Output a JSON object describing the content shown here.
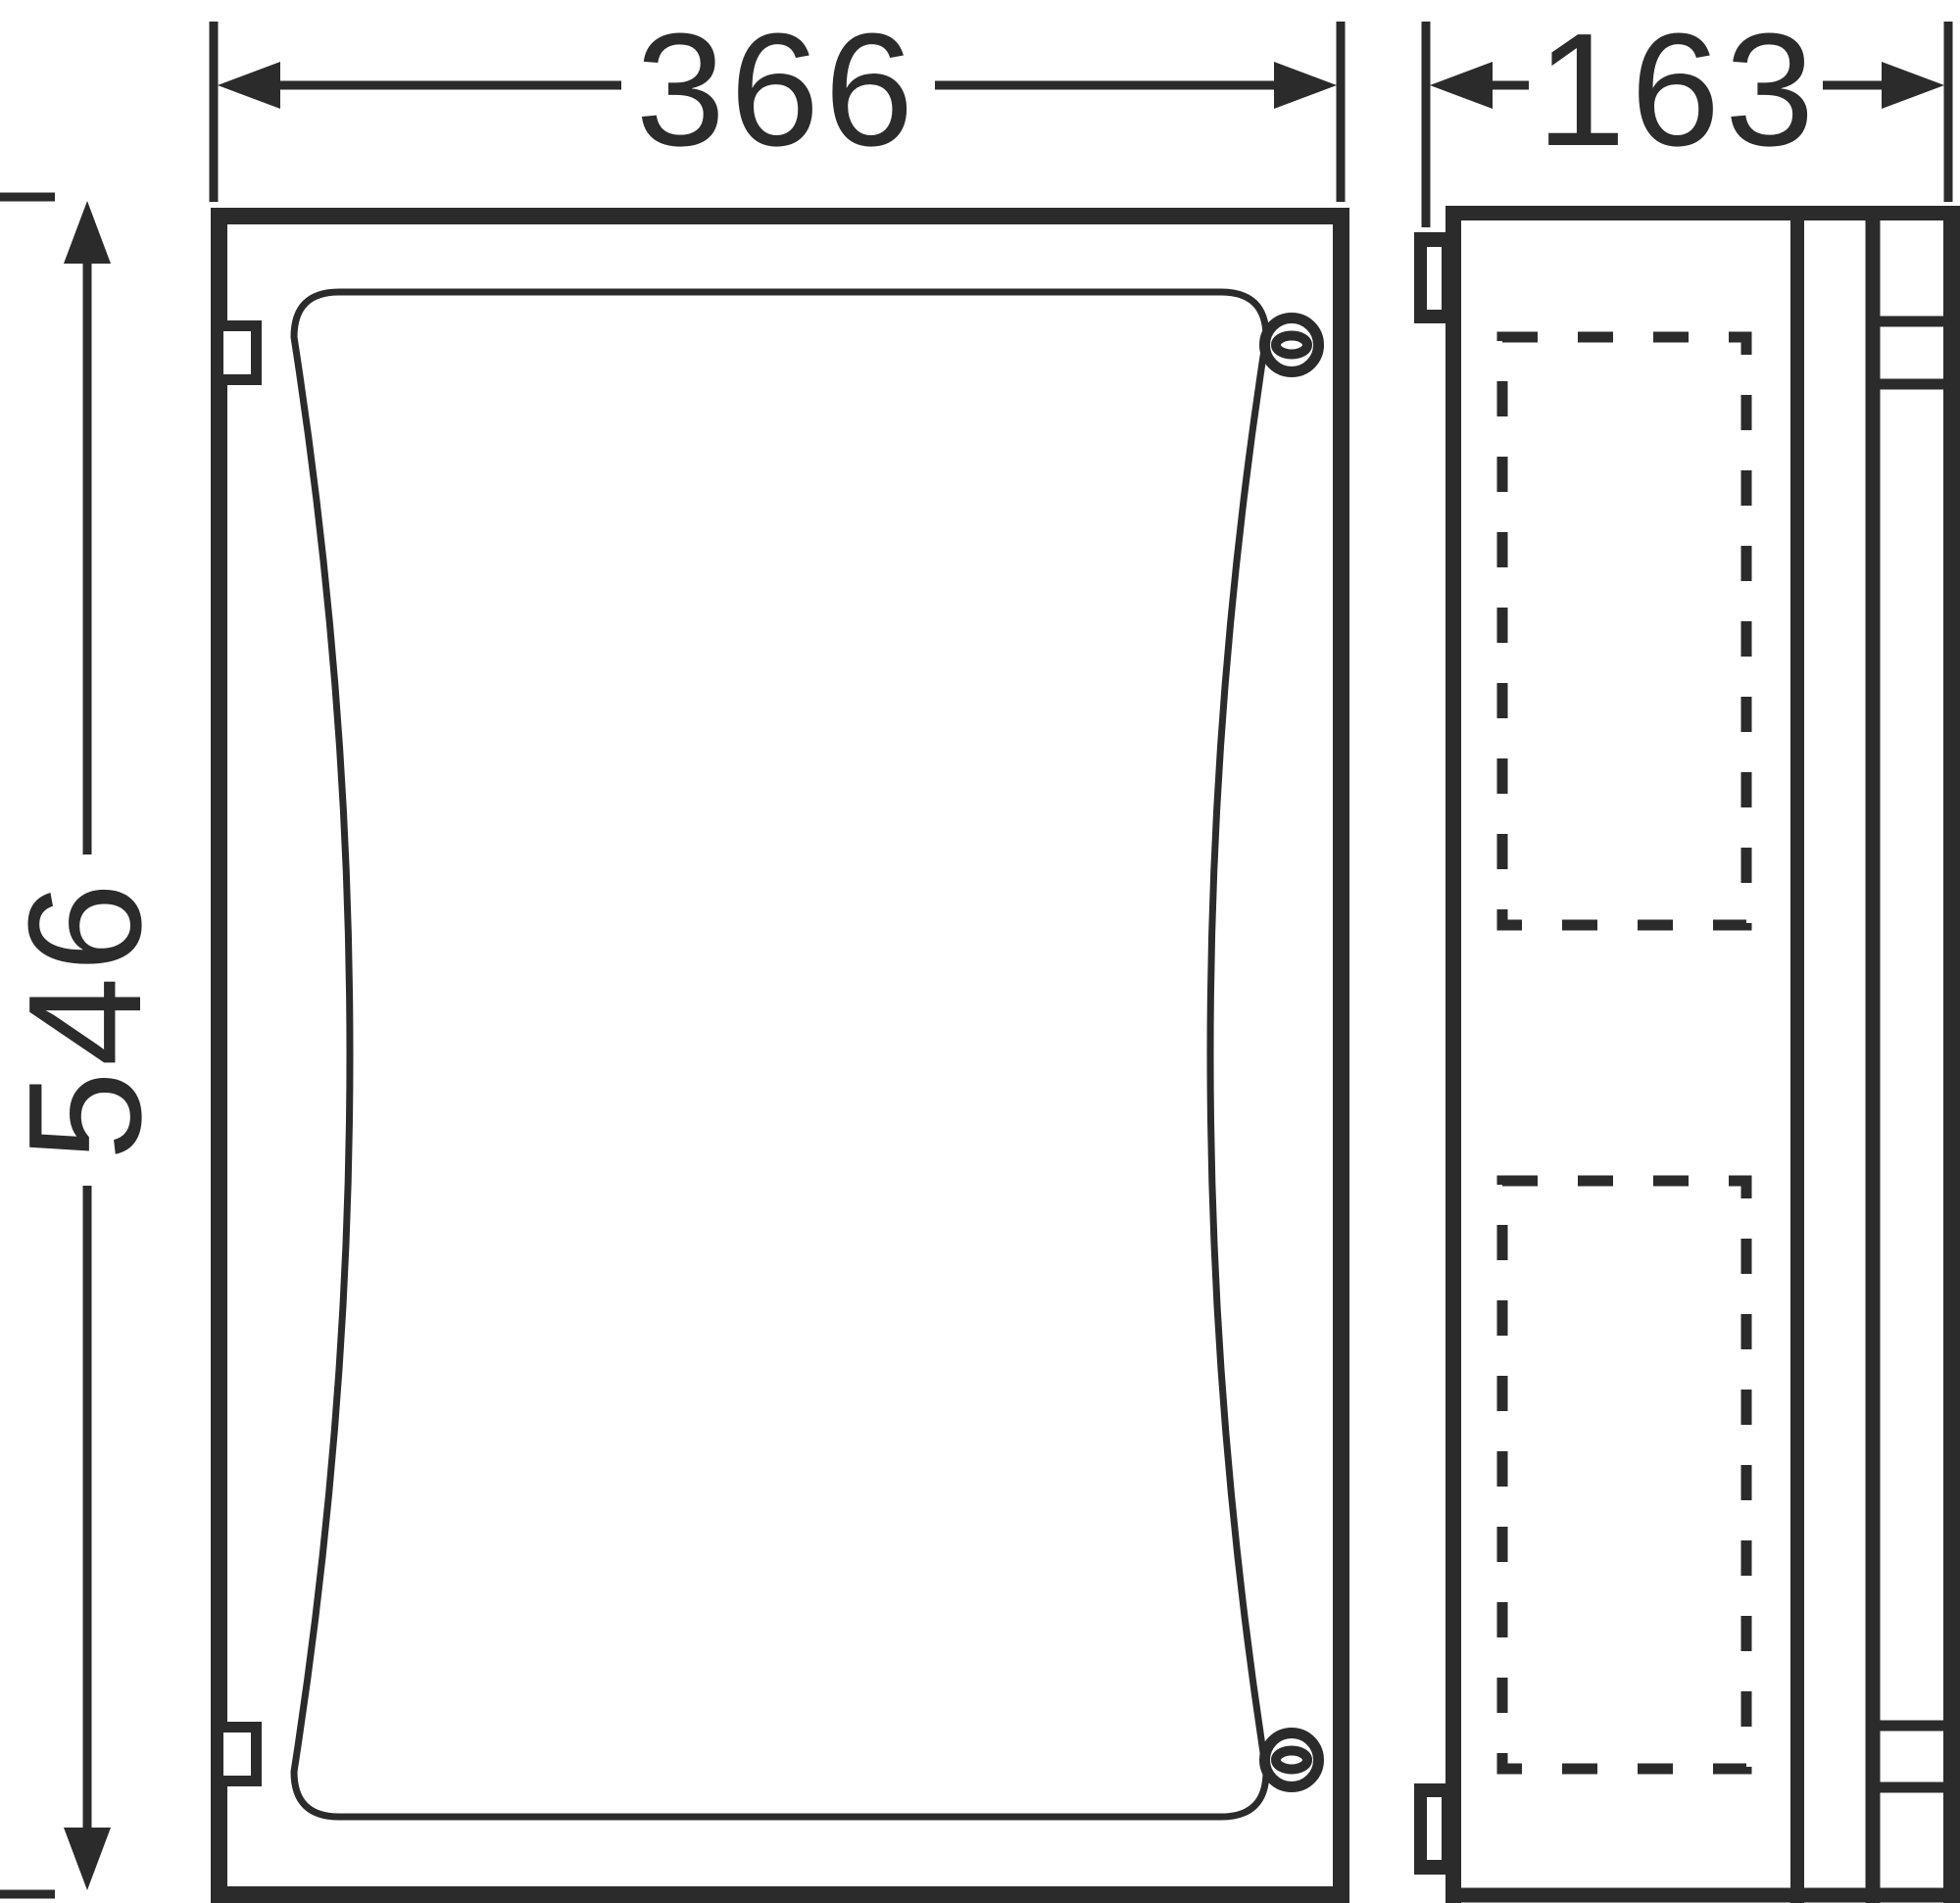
{
  "document": {
    "type": "technical-drawing",
    "subject": "enclosure-front-and-side-views"
  },
  "colors": {
    "ink": "#2b2b2b",
    "paper": "#ffffff"
  },
  "dimensions": {
    "front_width_mm": "366",
    "front_height_mm": "546",
    "side_depth_mm": "163"
  }
}
